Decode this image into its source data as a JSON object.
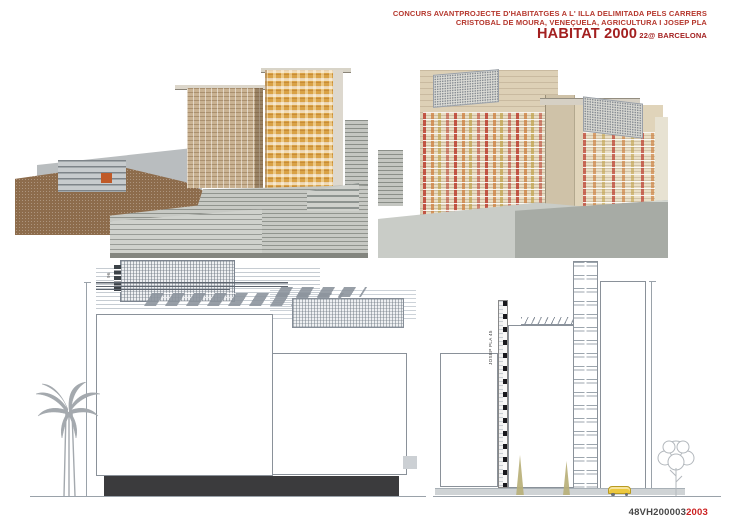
{
  "header": {
    "line1": "CONCURS AVANTPROJECTE D'HABITATGES A L' ILLA DELIMITADA PELS CARRERS",
    "line2": "CRISTOBAL DE MOURA, VENEÇUELA, AGRICULTURA I JOSEP PLA",
    "title": "HABITAT 2000",
    "subtitle": "22@ BARCELONA",
    "accent_color": "#b5372d",
    "title_color": "#a32020"
  },
  "footer": {
    "code": "48VH200003",
    "year": "2003",
    "year_color": "#cc2020"
  },
  "photos": {
    "left_model": {
      "tower_beige_color": "#c9b292",
      "tower_orange_color": "#d9a246",
      "ground_color": "#8d6c4c"
    },
    "right_model": {
      "panel_colors": [
        "#bb392b",
        "#cd7d3c",
        "#c1a24a"
      ],
      "body_color": "#ddd0b6"
    }
  },
  "elevations": {
    "palette": {
      "W": "#ffffff",
      "M": "#d45cc6",
      "O": "#e2885c",
      "Y": "#dcc76b"
    },
    "left": {
      "roof_label": "96",
      "building_a": {
        "floors": [
          "WWMWWOYWWOMWWOWWMWOWWW",
          "WMWYWOWMYWWOWYWMWWOWWW",
          "WWMWOWYOWWMWWOYWWMWWOW",
          "WMWWOYWWMWOWWYWWOWMWWW",
          "WWMWWOYWWOWMWWOWWYWMWW",
          "WMWWYOWWMWWOWYWWMWOWWW",
          "WWMWOWWYWMWWOWWYWWMOWW",
          "WWMWWOYWWMWWOWYWWMWWOW"
        ]
      },
      "building_b": {
        "floors": [
          "WWOMWWYWWOWMWWOWW",
          "WMWWOYWWMWWOWYWWM",
          "WWMWOWYWWMWOWWYWW",
          "WOWMWWYWOWWMWWOWW",
          "WWMWWOYWWMWWOWWYW",
          "WMWWOWYWWOWMWWOWW",
          "WWOMWWYWWMWWOWYWW"
        ]
      }
    },
    "right": {
      "street_label": "JOSEP PLA 45",
      "tower_left": {
        "floors": [
          "MWYWWW",
          "OMWWOW",
          "WWMYWW",
          "MWWYWO",
          "WOWMWW",
          "OWWMWY",
          "WMWOWW"
        ]
      },
      "tower_mid": {
        "floors": [
          "OWWMYW",
          "WMYWWO",
          "WWMWOW",
          "MWWYWO",
          "WOWMWW",
          "WWYMWO",
          "MWWOWW",
          "OWWMWY",
          "WMWWOW"
        ]
      },
      "tower_right": {
        "floors": [
          "YMWWOW",
          "WWYWWM",
          "OWWMWW",
          "WMYWWO",
          "WWMWOW",
          "YWWMWW",
          "OWWYWM",
          "WWMWWO",
          "MWWYWW",
          "OWMWWY",
          "WYWWMW"
        ]
      }
    }
  }
}
